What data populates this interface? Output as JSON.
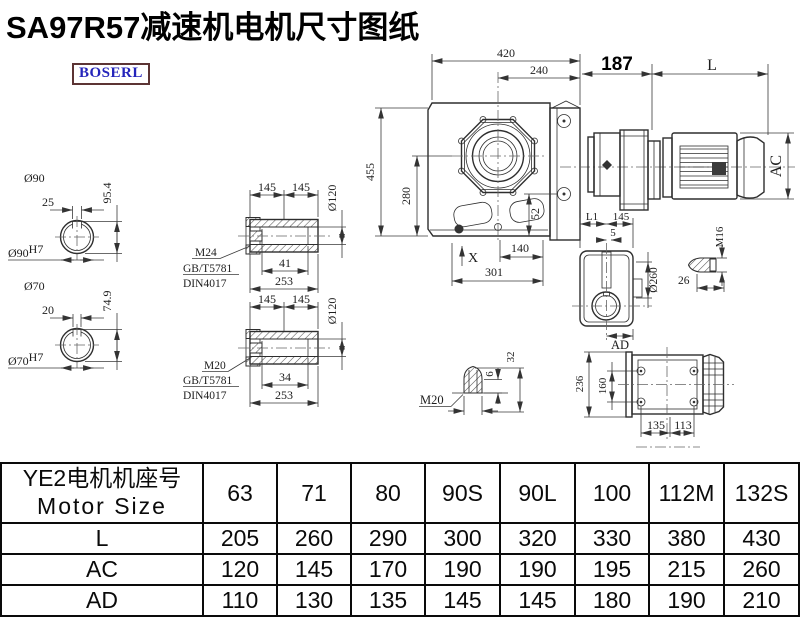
{
  "title": "SA97R57减速机电机尺寸图纸",
  "logo": "BOSERL",
  "drawing": {
    "main": {
      "d420": "420",
      "d240": "240",
      "d187": "187",
      "dL": "L",
      "dAC": "AC",
      "d455": "455",
      "d280": "280",
      "d52": "52",
      "dX": "X",
      "d140": "140",
      "d301": "301"
    },
    "shaft90": {
      "dia": "Ø90",
      "key_w": "25",
      "key_h": "95.4",
      "fit": "Ø90",
      "fit_sup": "H7"
    },
    "shaft70": {
      "dia": "Ø70",
      "key_w": "20",
      "key_h": "74.9",
      "fit": "Ø70",
      "fit_sup": "H7"
    },
    "hub_m24": {
      "l145a": "145",
      "l145b": "145",
      "dia": "Ø120",
      "thread": "M24",
      "std1": "GB/T5781",
      "std2": "DIN4017",
      "d41": "41",
      "d253": "253"
    },
    "hub_m20": {
      "l145a": "145",
      "l145b": "145",
      "dia": "Ø120",
      "thread": "M20",
      "std1": "GB/T5781",
      "std2": "DIN4017",
      "d34": "34",
      "d253": "253"
    },
    "side": {
      "dL1": "L1",
      "d145": "145",
      "d5": "5",
      "dia": "Ø260",
      "dAD": "AD"
    },
    "m16": {
      "thread": "M16",
      "d26": "26"
    },
    "m20cone": {
      "thread": "M20",
      "d6": "6",
      "d32": "32"
    },
    "top": {
      "d236": "236",
      "d160": "160",
      "d135": "135",
      "d113": "113"
    }
  },
  "table": {
    "header_line1": "YE2电机机座号",
    "header_line2": "Motor Size",
    "columns": [
      "63",
      "71",
      "80",
      "90S",
      "90L",
      "100",
      "112M",
      "132S"
    ],
    "rows": [
      {
        "label": "L",
        "values": [
          "205",
          "260",
          "290",
          "300",
          "320",
          "330",
          "380",
          "430"
        ]
      },
      {
        "label": "AC",
        "values": [
          "120",
          "145",
          "170",
          "190",
          "190",
          "195",
          "215",
          "260"
        ]
      },
      {
        "label": "AD",
        "values": [
          "110",
          "130",
          "135",
          "145",
          "145",
          "180",
          "190",
          "210"
        ]
      }
    ]
  }
}
